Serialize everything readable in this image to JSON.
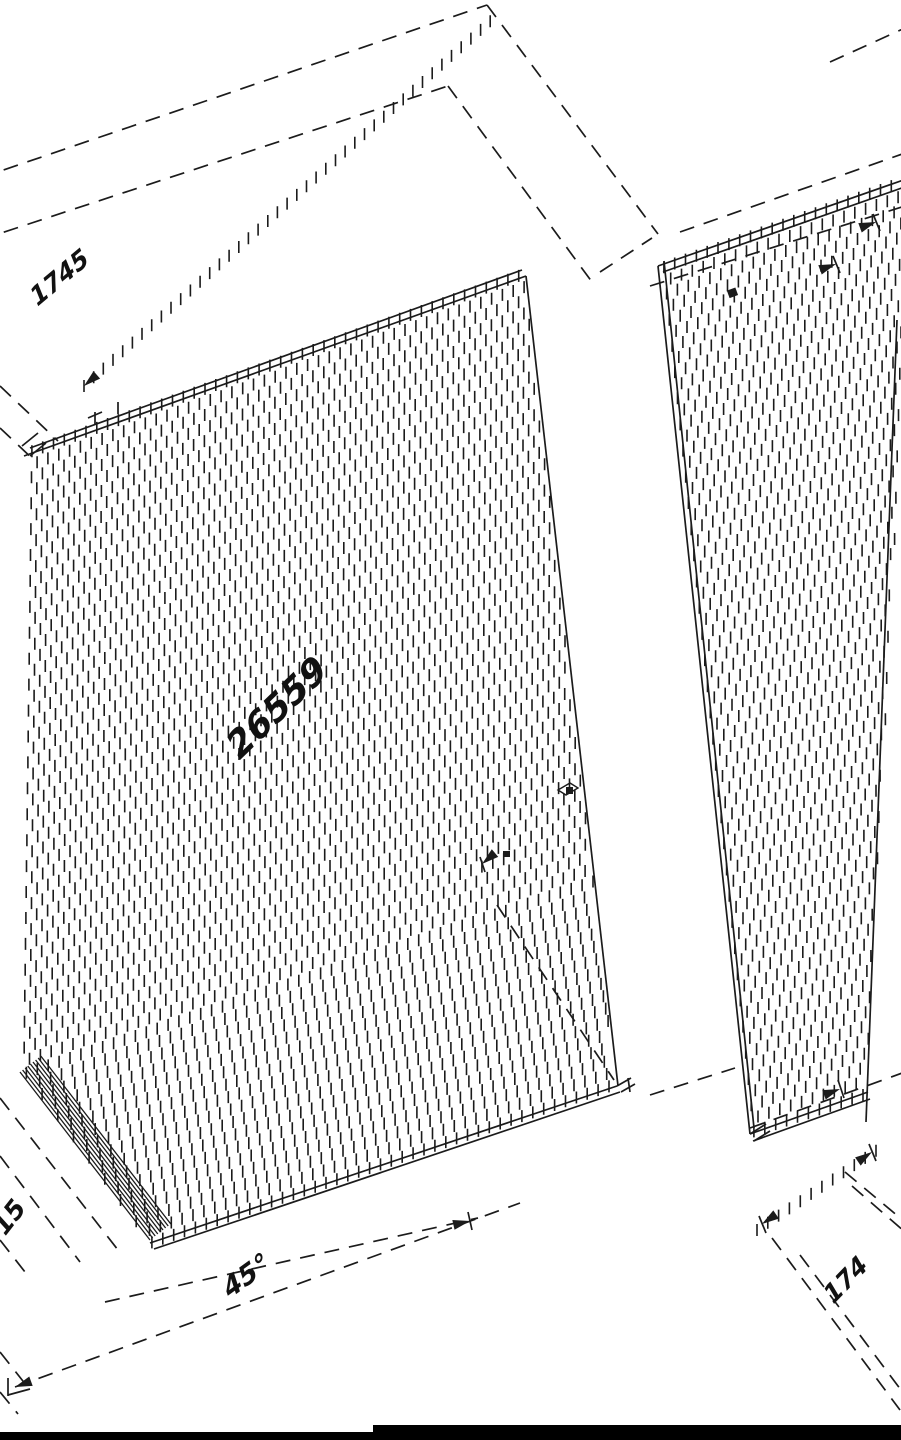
{
  "drawing": {
    "title": "isometric-panel-assembly-drawing",
    "colors": {
      "background": "#ffffff",
      "ink": "#1b1b1b"
    },
    "annotations": [
      {
        "id": "dim-top-left",
        "text": "1745",
        "x": 36,
        "y": 308,
        "rotation": -40,
        "skew": -18,
        "size": 25
      },
      {
        "id": "dim-middle",
        "text": "26559",
        "x": 238,
        "y": 762,
        "rotation": -44,
        "skew": -15,
        "size": 36
      },
      {
        "id": "dim-bottom-center",
        "text": "45°",
        "x": 228,
        "y": 1300,
        "rotation": -36,
        "skew": -18,
        "size": 27
      },
      {
        "id": "dim-bottom-left",
        "text": "15",
        "x": 4,
        "y": 1238,
        "rotation": -52,
        "skew": -10,
        "size": 26
      },
      {
        "id": "dim-bottom-right",
        "text": "174",
        "x": 832,
        "y": 1306,
        "rotation": -46,
        "skew": -15,
        "size": 25
      }
    ],
    "bottom_bar": {
      "color": "#000000",
      "thin": {
        "x": 0,
        "y": 1432,
        "w": 901,
        "h": 8
      },
      "thick": {
        "x": 373,
        "y": 1425,
        "w": 528,
        "h": 15
      }
    }
  }
}
